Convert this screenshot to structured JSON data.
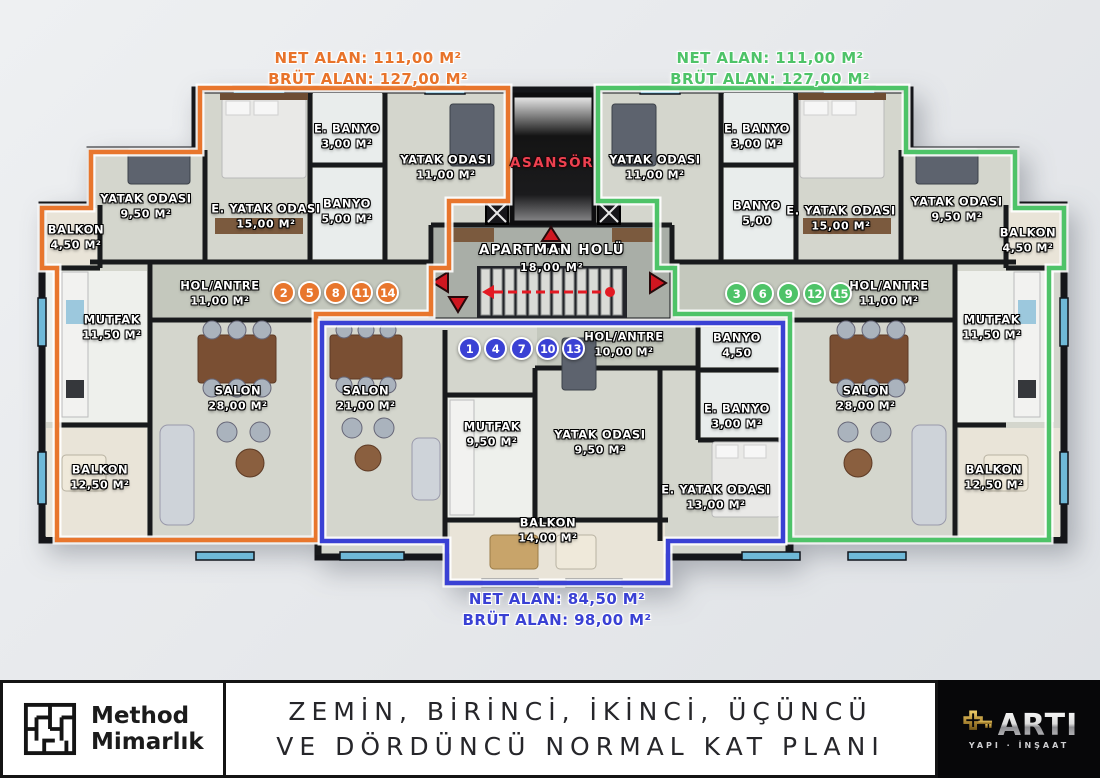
{
  "stats": {
    "left": {
      "net": "NET ALAN: 111,00 M²",
      "brut": "BRÜT ALAN: 127,00 M²"
    },
    "right": {
      "net": "NET ALAN: 111,00 M²",
      "brut": "BRÜT ALAN: 127,00 M²"
    },
    "bottom": {
      "net": "NET ALAN: 84,50 M²",
      "brut": "BRÜT ALAN: 98,00 M²"
    }
  },
  "core": {
    "elevator_label": "ASANSÖR",
    "hall_name": "APARTMAN HOLÜ",
    "hall_area": "18,00 M²"
  },
  "apartments": [
    {
      "id": "left-orange",
      "color": "#e8762d",
      "units": [
        "2",
        "5",
        "8",
        "11",
        "14"
      ],
      "rooms": [
        {
          "name": "YATAK ODASI",
          "area": "9,50 M²"
        },
        {
          "name": "E. YATAK ODASI",
          "area": "15,00 M²"
        },
        {
          "name": "E. BANYO",
          "area": "3,00 M²"
        },
        {
          "name": "BANYO",
          "area": "5,00 M²"
        },
        {
          "name": "YATAK ODASI",
          "area": "11,00 M²"
        },
        {
          "name": "BALKON",
          "area": "4,50 M²"
        },
        {
          "name": "MUTFAK",
          "area": "11,50 M²"
        },
        {
          "name": "HOL/ANTRE",
          "area": "11,00 M²"
        },
        {
          "name": "SALON",
          "area": "28,00 M²"
        },
        {
          "name": "BALKON",
          "area": "12,50 M²"
        }
      ]
    },
    {
      "id": "center-blue",
      "color": "#3a41d4",
      "units": [
        "1",
        "4",
        "7",
        "10",
        "13"
      ],
      "rooms": [
        {
          "name": "SALON",
          "area": "21,00 M²"
        },
        {
          "name": "MUTFAK",
          "area": "9,50 M²"
        },
        {
          "name": "YATAK ODASI",
          "area": "9,50 M²"
        },
        {
          "name": "E. YATAK ODASI",
          "area": "13,00 M²"
        },
        {
          "name": "HOL/ANTRE",
          "area": "10,00 M²"
        },
        {
          "name": "BANYO",
          "area": "4,50"
        },
        {
          "name": "E. BANYO",
          "area": "3,00 M²"
        },
        {
          "name": "BALKON",
          "area": "14,00 M²"
        }
      ]
    },
    {
      "id": "right-green",
      "color": "#4ec368",
      "units": [
        "3",
        "6",
        "9",
        "12",
        "15"
      ],
      "rooms": [
        {
          "name": "YATAK ODASI",
          "area": "11,00 M²"
        },
        {
          "name": "E. BANYO",
          "area": "3,00 M²"
        },
        {
          "name": "BANYO",
          "area": "5,00"
        },
        {
          "name": "E. YATAK ODASI",
          "area": "15,00 M²"
        },
        {
          "name": "YATAK ODASI",
          "area": "9,50 M²"
        },
        {
          "name": "BALKON",
          "area": "4,50 M²"
        },
        {
          "name": "HOL/ANTRE",
          "area": "11,00 M²"
        },
        {
          "name": "MUTFAK",
          "area": "11,50 M²"
        },
        {
          "name": "SALON",
          "area": "28,00 M²"
        },
        {
          "name": "BALKON",
          "area": "12,50 M²"
        }
      ]
    }
  ],
  "footer": {
    "studio_line1": "Method",
    "studio_line2": "Mimarlık",
    "title_line1": "ZEMİN, BİRİNCİ, İKİNCİ, ÜÇÜNCÜ",
    "title_line2": "VE DÖRDÜNCÜ NORMAL KAT PLANI",
    "brand_name": "ARTI",
    "brand_sub": "YAPI · İNŞAAT"
  },
  "colors": {
    "apartment_left": "#e8762d",
    "apartment_center": "#3a41d4",
    "apartment_right": "#4ec368",
    "egress_red": "#cf1620",
    "elevator_text": "#ee4150"
  }
}
